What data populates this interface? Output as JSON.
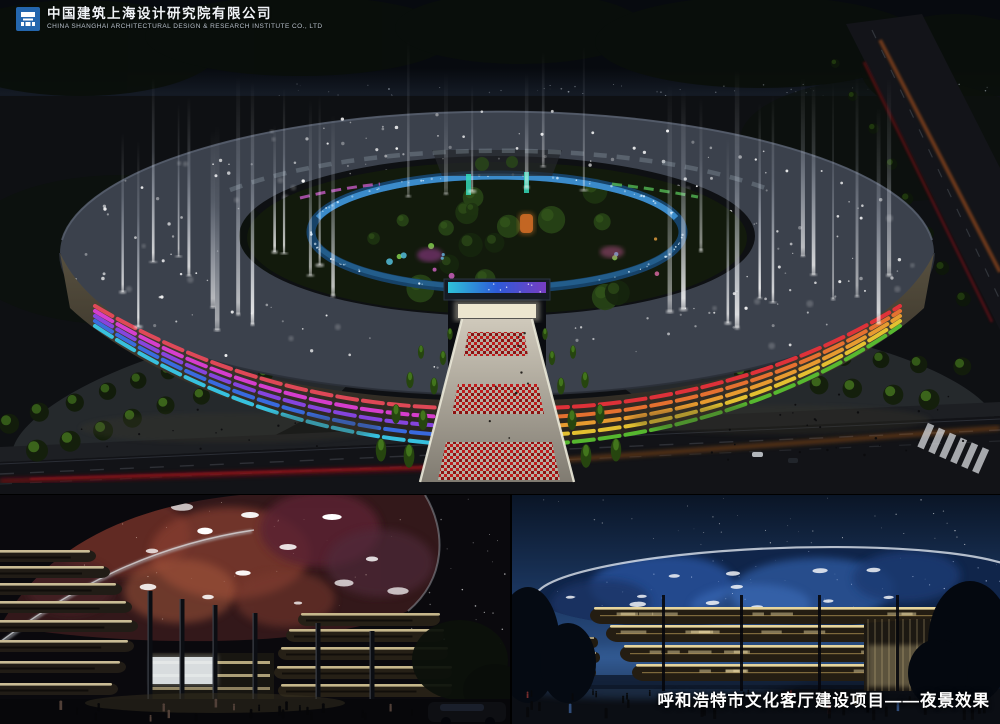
{
  "company_header": {
    "company_name_cn": "中国建筑上海设计研究院有限公司",
    "company_name_en": "CHINA SHANGHAI ARCHITECTURAL DESIGN & RESEARCH INSTITUTE CO., LTD",
    "logo_icon": "china-construction-shanghai-institute-mark",
    "logo_color": "#2466ad"
  },
  "project_caption": {
    "text": "呼和浩特市文化客厅建设项目——夜景效果"
  },
  "palette": {
    "background": "#000000",
    "ring_roof_gray": "#3b414c",
    "inner_ring_glass_glow": "#3d8fd0",
    "fountain_beam_white": "#f4f8ff",
    "plaza_pattern_red": "#c01c1c",
    "facade_left_bands": [
      "#e84a5a",
      "#de3ed6",
      "#8a46e8",
      "#3a6ee8",
      "#38c8e8"
    ],
    "facade_right_bands": [
      "#e8323a",
      "#ee7430",
      "#f0a030",
      "#edc832",
      "#58c030"
    ],
    "canopy_nebula_red": "#8a4030",
    "canopy_galaxy_blue": "#3b6fc4",
    "warm_louver_light": "#f2dfa4",
    "night_sky_blue": "#1d3a66"
  }
}
